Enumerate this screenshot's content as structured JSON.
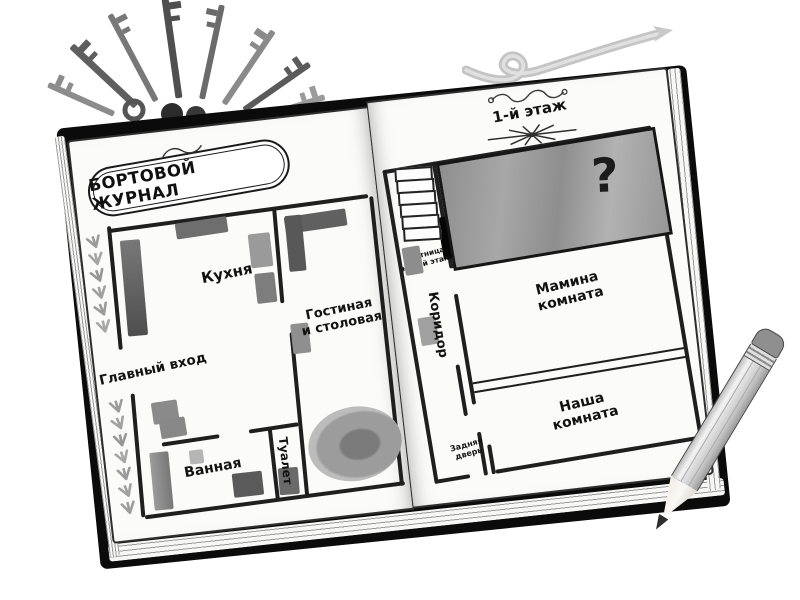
{
  "title": {
    "text": "БОРТОВОЙ ЖУРНАЛ"
  },
  "floor_header": {
    "text": "1-й этаж"
  },
  "rooms": {
    "kitchen": "Кухня",
    "main_entrance": "Главный вход",
    "living_line1": "Гостиная",
    "living_line2": "и столовая",
    "bathroom": "Ванная",
    "toilet": "Туалет",
    "corridor": "Коридор",
    "moms_room_line1": "Мамина",
    "moms_room_line2": "комната",
    "our_room_line1": "Наша",
    "our_room_line2": "комната",
    "mystery_mark": "?"
  },
  "annotations": {
    "stairs_line1": "Лестница",
    "stairs_line2": "на 2-й этаж",
    "back_door_line1": "Задняя",
    "back_door_line2": "дверь"
  },
  "colors": {
    "ink": "#1f1f1f",
    "paper": "#fbfbfa",
    "cover": "#0b0b0b",
    "mystery_fill": "#9a9a9a",
    "furniture_gray": "#8a8a8a"
  }
}
